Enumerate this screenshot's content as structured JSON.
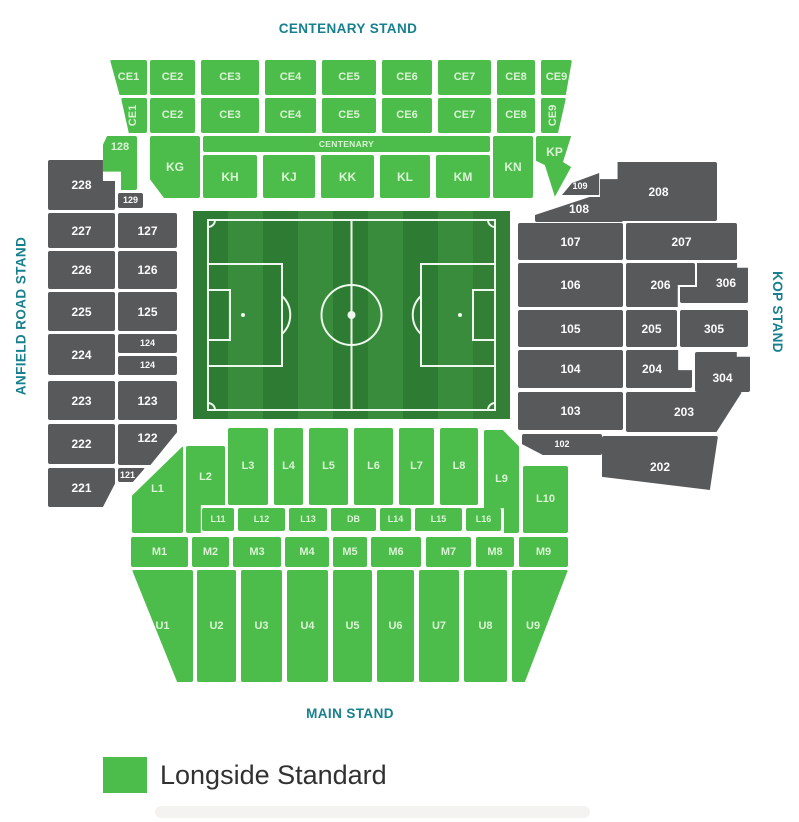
{
  "stands": {
    "top": "CENTENARY STAND",
    "bottom": "MAIN STAND",
    "left": "ANFIELD ROAD STAND",
    "right": "KOP STAND"
  },
  "legend": [
    {
      "label": "Longside Standard",
      "color": "#4cbd4a"
    }
  ],
  "colors": {
    "available": "#4cbd4a",
    "unavailable": "#58595b",
    "stand_label": "#17808e",
    "pitch_dark": "#2e7c33",
    "pitch_light": "#3a8c3d"
  },
  "sections": {
    "ce1_top": "CE1",
    "ce2_top": "CE2",
    "ce3_top": "CE3",
    "ce4_top": "CE4",
    "ce5_top": "CE5",
    "ce6_top": "CE6",
    "ce7_top": "CE7",
    "ce8_top": "CE8",
    "ce9_top": "CE9",
    "ce1_low": "CE1",
    "ce2_low": "CE2",
    "ce3_low": "CE3",
    "ce4_low": "CE4",
    "ce5_low": "CE5",
    "ce6_low": "CE6",
    "ce7_low": "CE7",
    "ce8_low": "CE8",
    "ce9_low": "CE9",
    "centenary_strip": "CENTENARY",
    "kg": "KG",
    "kh": "KH",
    "kj": "KJ",
    "kk": "KK",
    "kl": "KL",
    "km": "KM",
    "kn": "KN",
    "kp": "KP",
    "s128": "128",
    "s129": "129",
    "s228": "228",
    "s227": "227",
    "s226": "226",
    "s225": "225",
    "s224": "224",
    "s223": "223",
    "s222": "222",
    "s221": "221",
    "s127": "127",
    "s126": "126",
    "s125": "125",
    "s124a": "124",
    "s124b": "124",
    "s123": "123",
    "s122": "122",
    "s121": "121",
    "s109": "109",
    "s108": "108",
    "s107": "107",
    "s106": "106",
    "s105": "105",
    "s104": "104",
    "s103": "103",
    "s102": "102",
    "s208": "208",
    "s207": "207",
    "s206": "206",
    "s205": "205",
    "s204": "204",
    "s203": "203",
    "s202": "202",
    "s306": "306",
    "s305": "305",
    "s304": "304",
    "l1": "L1",
    "l2": "L2",
    "l3": "L3",
    "l4": "L4",
    "l5": "L5",
    "l6": "L6",
    "l7": "L7",
    "l8": "L8",
    "l9": "L9",
    "l10": "L10",
    "l11": "L11",
    "l12": "L12",
    "l13": "L13",
    "db": "DB",
    "l14": "L14",
    "l15": "L15",
    "l16": "L16",
    "m1": "M1",
    "m2": "M2",
    "m3": "M3",
    "m4": "M4",
    "m5": "M5",
    "m6": "M6",
    "m7": "M7",
    "m8": "M8",
    "m9": "M9",
    "u1": "U1",
    "u2": "U2",
    "u3": "U3",
    "u4": "U4",
    "u5": "U5",
    "u6": "U6",
    "u7": "U7",
    "u8": "U8",
    "u9": "U9"
  }
}
